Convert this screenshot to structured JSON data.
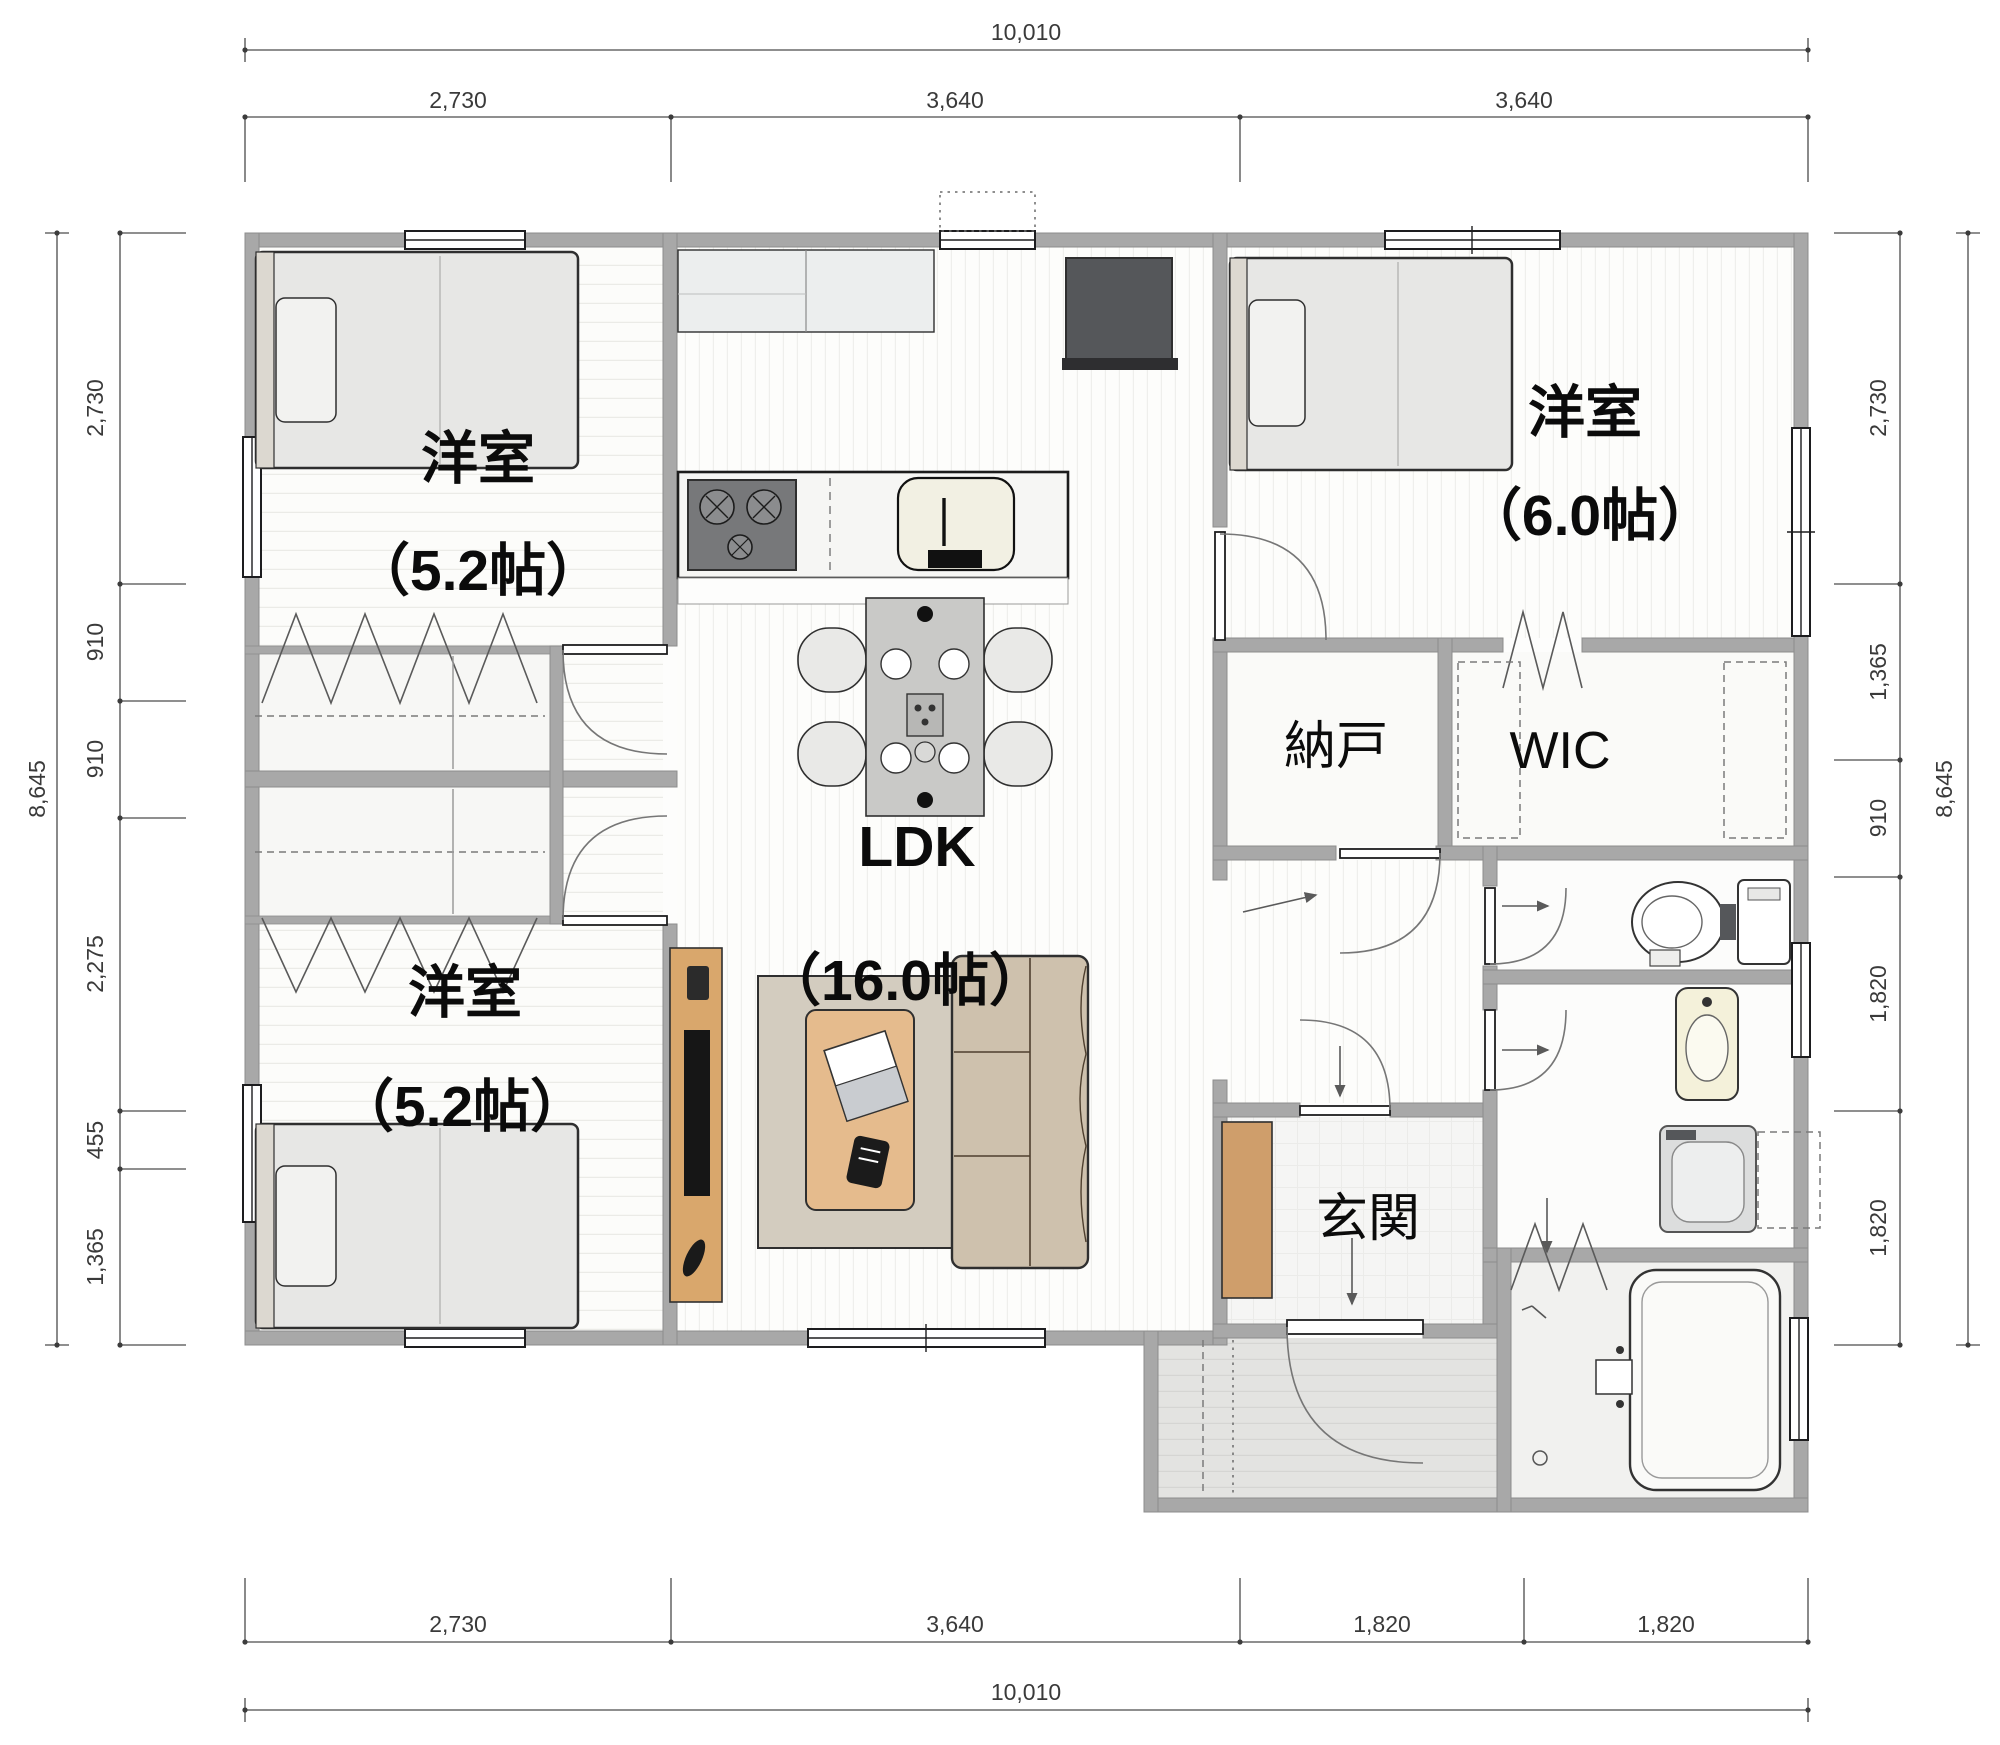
{
  "meta": {
    "type": "japanese-single-story-floor-plan"
  },
  "colors": {
    "wall": "#a8a8a8",
    "wood_accent": "#d5a36e",
    "floor": "#fcfcfb",
    "dark_appliance": "#55575a",
    "label_text": "#0b0b0b",
    "dimension_text": "#3a3a3a"
  },
  "rooms": [
    {
      "id": "bedroom-top-left",
      "label": "洋室",
      "size": "（5.2帖）"
    },
    {
      "id": "bedroom-bottom-left",
      "label": "洋室",
      "size": "（5.2帖）"
    },
    {
      "id": "ldk",
      "label": "LDK",
      "size": "（16.0帖）"
    },
    {
      "id": "bedroom-top-right",
      "label": "洋室",
      "size": "（6.0帖）"
    },
    {
      "id": "storage",
      "label": "納戸"
    },
    {
      "id": "walk-in-closet",
      "label": "WIC"
    },
    {
      "id": "entrance",
      "label": "玄関"
    }
  ],
  "dimensions": {
    "top": {
      "total": "10,010",
      "segments": [
        "2,730",
        "3,640",
        "3,640"
      ]
    },
    "bottom": {
      "total": "10,010",
      "segments": [
        "2,730",
        "3,640",
        "1,820",
        "1,820"
      ]
    },
    "left": {
      "total": "8,645",
      "segments": [
        "2,730",
        "910",
        "910",
        "2,275",
        "455",
        "1,365"
      ]
    },
    "right": {
      "total": "8,645",
      "segments": [
        "2,730",
        "1,365",
        "910",
        "1,820",
        "1,820"
      ]
    }
  },
  "furniture": [
    "single-bed",
    "single-bed",
    "single-bed",
    "kitchen-cabinet",
    "refrigerator",
    "gas-stove",
    "kitchen-sink",
    "dining-table",
    "dining-chair",
    "sofa",
    "coffee-table",
    "rug",
    "tv-board",
    "tv",
    "shoe-cabinet",
    "toilet",
    "washbasin",
    "washing-machine",
    "bathtub"
  ]
}
